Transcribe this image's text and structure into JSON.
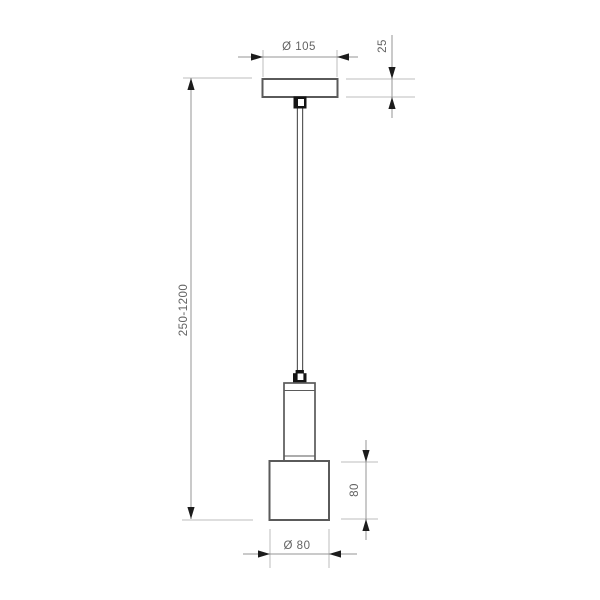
{
  "drawing": {
    "title": "pendant-lamp-dimension-drawing",
    "labels": {
      "canopy_diameter": "Ø 105",
      "canopy_height": "25",
      "suspension_length": "250-1200",
      "shade_height": "80",
      "shade_diameter": "Ø 80"
    },
    "parts": [
      "ceiling-canopy",
      "ceiling-cord-grip",
      "suspension-cord",
      "lamp-cord-grip",
      "lamp-tube",
      "lamp-shade"
    ]
  },
  "colors": {
    "object_line": "#5a5a5a",
    "grip_color": "#141414",
    "dimension_line": "#949494",
    "extension_line": "#bdbdbd",
    "arrow_color": "#1c1c1c",
    "text_color": "#636363",
    "background": "#ffffff"
  }
}
